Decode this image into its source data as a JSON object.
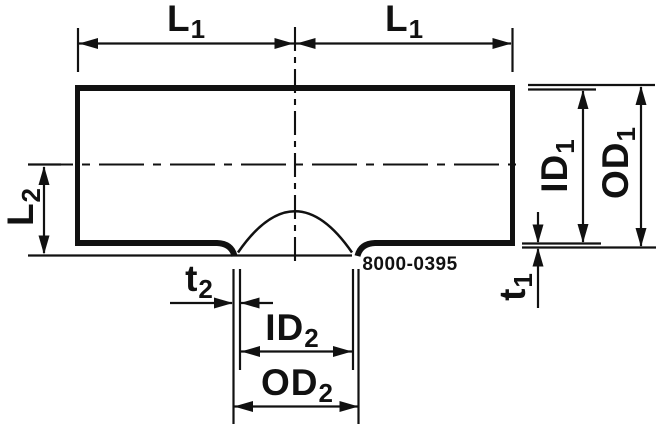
{
  "drawing": {
    "type": "technical-dimension-drawing",
    "subject": "pipe-tee-fitting-cross-section",
    "part_number": "8000-0395",
    "colors": {
      "ink": "#111111",
      "background": "#ffffff"
    },
    "dimension_labels": {
      "l1_left": {
        "base": "L",
        "sub": "1"
      },
      "l1_right": {
        "base": "L",
        "sub": "1"
      },
      "l2": {
        "base": "L",
        "sub": "2"
      },
      "t2": {
        "base": "t",
        "sub": "2"
      },
      "id2": {
        "base": "ID",
        "sub": "2"
      },
      "od2": {
        "base": "OD",
        "sub": "2"
      },
      "id1": {
        "base": "ID",
        "sub": "1"
      },
      "od1": {
        "base": "OD",
        "sub": "1"
      },
      "t1": {
        "base": "t",
        "sub": "1"
      }
    }
  }
}
